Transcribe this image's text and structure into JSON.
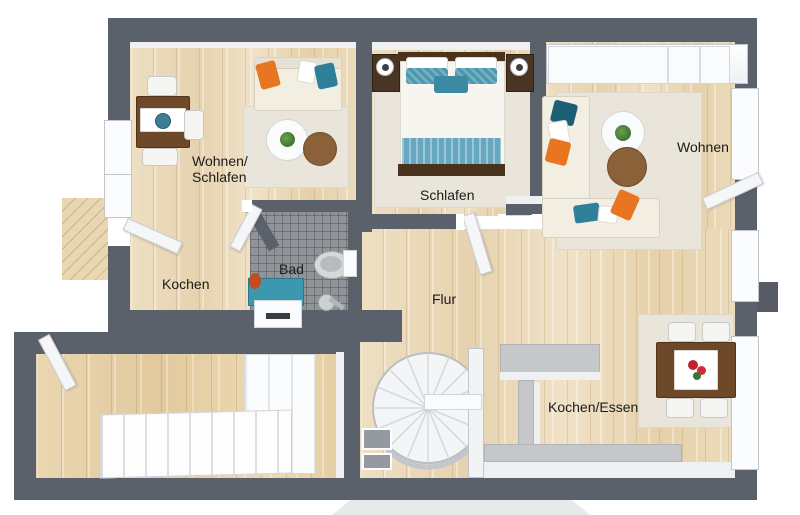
{
  "labels": {
    "wohnen_schlafen_line1": "Wohnen/",
    "wohnen_schlafen_line2": "Schlafen",
    "schlafen": "Schlafen",
    "wohnen": "Wohnen",
    "kochen": "Kochen",
    "bad": "Bad",
    "flur": "Flur",
    "kochen_essen": "Kochen/Essen"
  },
  "colors": {
    "wall": "#5b616b",
    "floor_wood": "#ebdbbc",
    "floor_wood_dark": "#e7d2ab",
    "bath_tile": "#909398",
    "kitchen_counter": "#c6c7c9",
    "rug": "#e9e5da",
    "accent_teal": "#2e7f99",
    "accent_orange": "#e8751f",
    "furniture_wood": "#6d4829",
    "bed_frame": "#49331f",
    "label_text": "#1b1b1b"
  },
  "furniture": {
    "wohnen_schlafen": [
      "dining-table",
      "dining-chairs",
      "sofa",
      "coffee-table",
      "side-table",
      "rug",
      "plant"
    ],
    "schlafen": [
      "double-bed",
      "nightstand-left",
      "nightstand-right",
      "bedside-lamps",
      "rug"
    ],
    "wohnen": [
      "wardrobe",
      "corner-sofa",
      "coffee-table",
      "side-table",
      "rug",
      "plant",
      "open-door"
    ],
    "bad": [
      "toilet",
      "vanity-countertop",
      "sink-cabinet",
      "shower"
    ],
    "kochen_essen": [
      "kitchen-counter-l-shape",
      "dining-table",
      "dining-chairs",
      "rug",
      "flower-vase"
    ],
    "circulation": [
      "spiral-staircase",
      "straight-staircase",
      "entry-landing",
      "balcony-deck"
    ]
  }
}
